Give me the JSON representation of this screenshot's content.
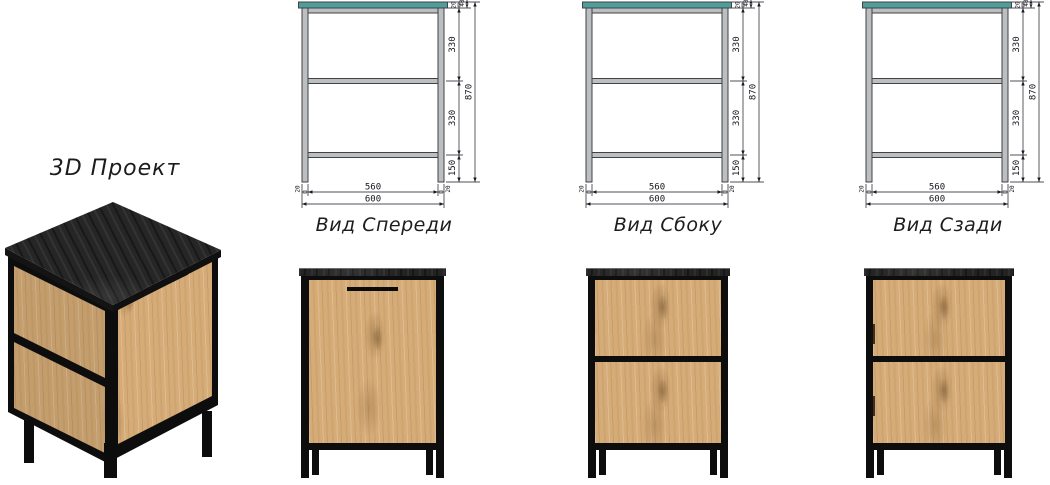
{
  "project_label": "3D Проект",
  "views": {
    "front": {
      "label": "Вид Спереди"
    },
    "side": {
      "label": "Вид Сбоку"
    },
    "back": {
      "label": "Вид Сзади"
    }
  },
  "dims": {
    "top_thickness": "20",
    "top_section": "40",
    "section_upper": "330",
    "section_lower": "330",
    "leg_height": "150",
    "total_height": "870",
    "inner_width": "560",
    "total_width": "600",
    "leg_left": "20",
    "leg_right": "20"
  },
  "materials": {
    "counter_top": "#4f9e9c",
    "frame_metal": "#bcbfc0",
    "wood": "#d3a873",
    "dark_top": "#242424",
    "dimension_lines": "#1a1a22",
    "frame_black": "#0d0d0d"
  }
}
